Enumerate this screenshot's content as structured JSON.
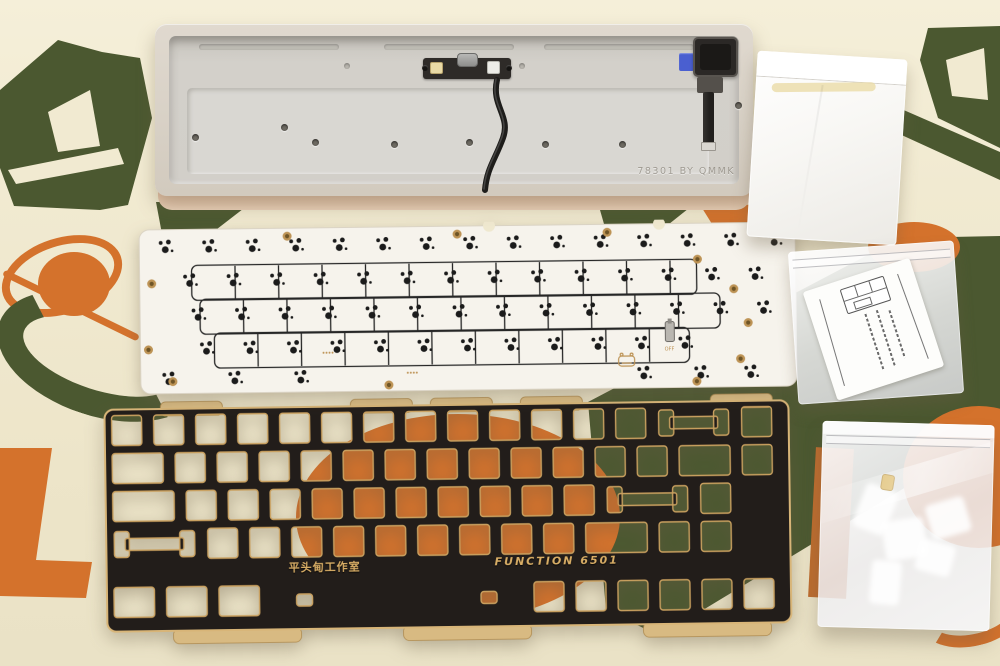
{
  "palette": {
    "mat": "#EFE8CF",
    "green": "#4B5830",
    "orange": "#D4722C",
    "case_shell": "#D8D0C5",
    "pcb_white": "#F6F3EC",
    "pcb_dot": "#1B1B1B",
    "gold": "#BD9355",
    "plate_black": "#221D1A",
    "plate_gold": "#C9A05F",
    "tab_gold": "#D8BA82",
    "blue": "#4A5FD0"
  },
  "case": {
    "engraving": "78301 BY QMMK",
    "screw_holes": [
      [
        23,
        98
      ],
      [
        112,
        88
      ],
      [
        143,
        103
      ],
      [
        222,
        105
      ],
      [
        297,
        103
      ],
      [
        373,
        105
      ],
      [
        450,
        105
      ]
    ],
    "post_holes": [
      [
        175,
        27
      ],
      [
        350,
        27
      ]
    ]
  },
  "pcb": {
    "rows": [
      {
        "y": 24,
        "start": 28,
        "step": 43.5,
        "count": 15
      },
      {
        "y": 58,
        "start": 52,
        "step": 43.5,
        "count": 14
      },
      {
        "y": 92,
        "start": 60,
        "step": 43.5,
        "count": 14
      },
      {
        "y": 126,
        "start": 68,
        "step": 43.5,
        "count": 12
      }
    ],
    "bottom_row": {
      "y": 156,
      "xs": [
        30,
        96,
        162,
        505,
        562,
        612
      ]
    },
    "outlines": [
      {
        "x": 54,
        "y": 40,
        "w": 505,
        "h": 35
      },
      {
        "x": 62,
        "y": 74,
        "w": 520,
        "h": 35
      },
      {
        "x": 76,
        "y": 108,
        "w": 475,
        "h": 35
      }
    ],
    "screw_holes": [
      [
        14,
        58
      ],
      [
        10,
        124
      ],
      [
        34,
        156
      ],
      [
        150,
        12
      ],
      [
        320,
        12
      ],
      [
        470,
        12
      ],
      [
        560,
        40
      ],
      [
        596,
        70
      ],
      [
        610,
        104
      ],
      [
        602,
        140
      ],
      [
        558,
        162
      ],
      [
        250,
        162
      ]
    ],
    "gold_marks": [
      [
        185,
        129
      ],
      [
        269,
        150
      ]
    ],
    "switch_component": {
      "x": 527,
      "y": 102
    },
    "switch_mark": "OFF",
    "logo": "hippo-logo"
  },
  "plate": {
    "studio_label": "平头甸工作室",
    "model_label": "FUNCTION 6501",
    "unit": 42,
    "rows": [
      {
        "y": 14,
        "keys": [
          1,
          1,
          1,
          1,
          1,
          1,
          1,
          1,
          1,
          1,
          1,
          1,
          1,
          2,
          1
        ]
      },
      {
        "y": 52,
        "keys": [
          1.5,
          1,
          1,
          1,
          1,
          1,
          1,
          1,
          1,
          1,
          1,
          1,
          1,
          1.5,
          1
        ]
      },
      {
        "y": 90,
        "keys": [
          1.75,
          1,
          1,
          1,
          1,
          1,
          1,
          1,
          1,
          1,
          1,
          2.25,
          1
        ]
      },
      {
        "y": 128,
        "keys": [
          2.25,
          1,
          1,
          1,
          1,
          1,
          1,
          1,
          1,
          1,
          1.75,
          1,
          1
        ]
      },
      {
        "y": 186,
        "keys": [
          1.25,
          1.25,
          1.25,
          6.25,
          1,
          1,
          1,
          1,
          1,
          1
        ]
      }
    ],
    "top_tabs": [
      60,
      250,
      330,
      420,
      610
    ],
    "bottom_tabs": [
      70,
      300,
      540
    ]
  },
  "background_shapes": [
    "letter-a-left",
    "letter-a-right",
    "orange-planet-with-ring",
    "green-swirl",
    "orange-letter-l",
    "orange-circle",
    "green-diagonal-blob",
    "orange-blob-right"
  ]
}
